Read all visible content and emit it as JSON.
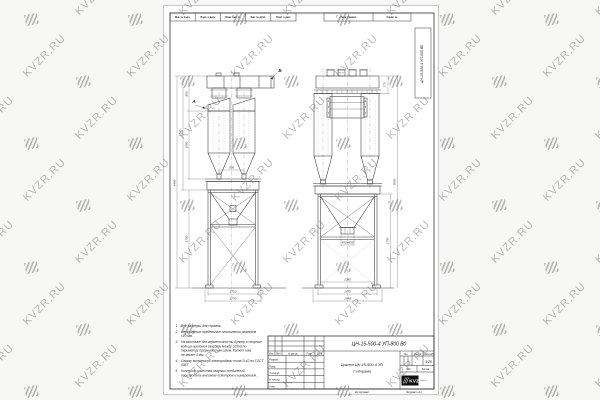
{
  "watermark": {
    "text": "KVZR.RU"
  },
  "stamps": {
    "top_cells": [
      "Инв. № подл.",
      "Подп. и дата",
      "Взам. инв. №",
      "Инв. № дубл.",
      "Подп. и дата"
    ],
    "top_right_cells": [
      "Перв. примен.",
      "Справ. №"
    ],
    "side_designation": "ЦН-15-500-4 УП-800 В0"
  },
  "drawing": {
    "view_a": "А",
    "view_b": "Б",
    "dims": {
      "lv_total": "4460",
      "lv_assembly": "3180",
      "lv_head": "885",
      "lv_body": "1080",
      "lv_frame": "1750",
      "lv_cones": "500",
      "lv_frame_w": "1710",
      "lv_base_w": "1770",
      "rv_top": "175",
      "rv_frame_h": "1750",
      "rv_total": "3005",
      "rv_hopper": "450×450",
      "rv_inner_w": "1380",
      "rv_frame_w": "1470",
      "rv_base_w": "1580"
    }
  },
  "notes": {
    "items": [
      {
        "num": "1.",
        "lines": [
          "Все размеры для справок."
        ]
      },
      {
        "num": "2.",
        "lines": [
          "Неуказанные предельные отклонения размеров",
          "±10 мм."
        ]
      },
      {
        "num": "3.",
        "lines": [
          "На монтаже для герметичности бункер и опорные",
          "кольца циклонов сварить между собой по",
          "периметру прерывистым швом.  Катет шва",
          "не менее 4 мм."
        ]
      },
      {
        "num": "4.",
        "lines": [
          "Сварку выполнять электродами типа Э-42 по ГОСТ",
          "9467."
        ]
      },
      {
        "num": "5.",
        "lines": [
          "Контроль качества сварных соединений",
          "производить внешним осмотром и измерением."
        ]
      }
    ]
  },
  "title_block": {
    "designation": "ЦН-15-500-4 УП-800  В0",
    "name_line1": "Циклон ЦН-15-500-4 УП",
    "name_line2": "с опорами",
    "header_cols": [
      "Изм.",
      "Лист",
      "№ докум.",
      "Подп.",
      "Дата"
    ],
    "rows": [
      "Разраб.",
      "Пров.",
      "Т.контр.",
      "Н.контр.",
      "Утв."
    ],
    "lit_label": "Лит.",
    "mass_label": "Масса",
    "scale_label": "Масштаб",
    "scale_value": "1:25",
    "sheet_label": "Лист",
    "sheets_label": "Листов",
    "logo_text": "KVZR",
    "logo_caption": "kvzr.ru",
    "copied_label": "Копировал",
    "format_label": "Формат  А3"
  }
}
